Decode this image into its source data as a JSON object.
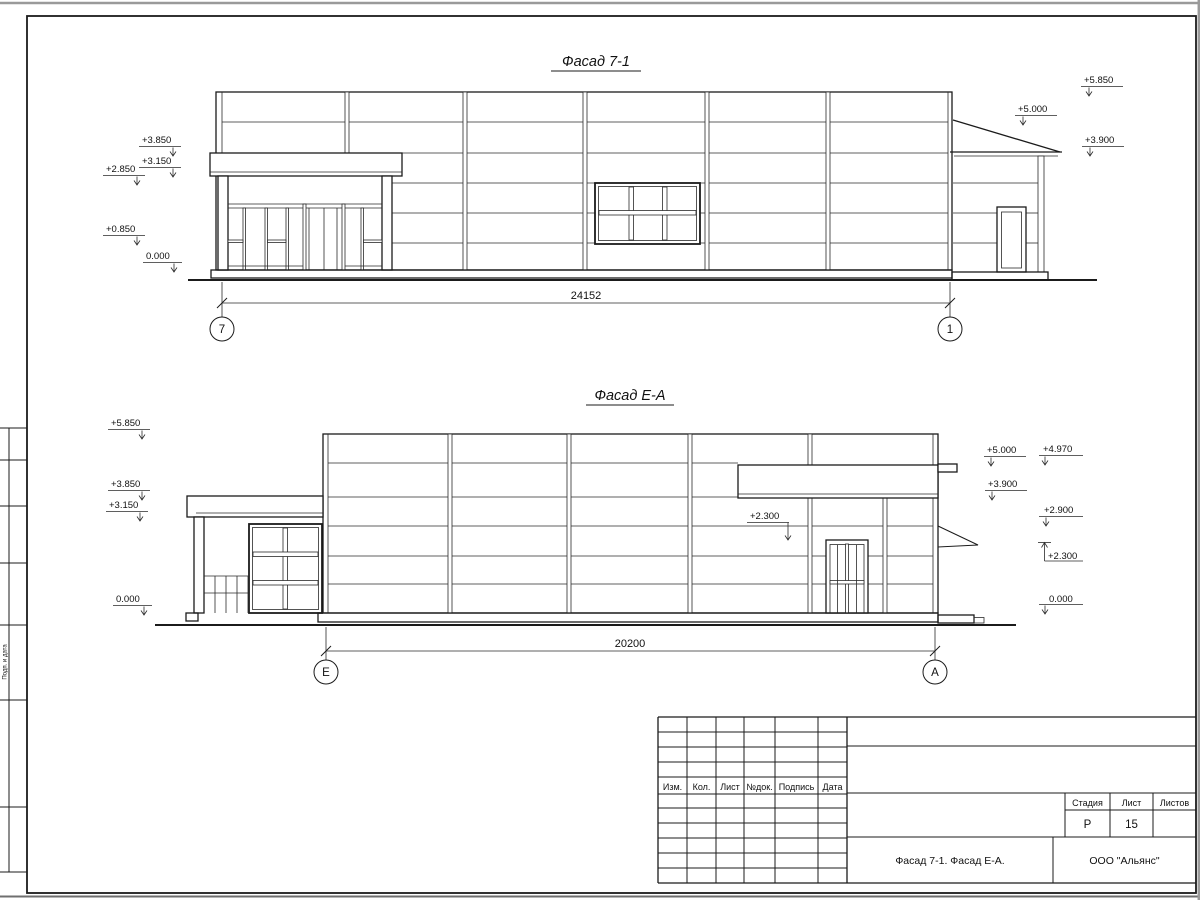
{
  "sheet": {
    "left_stamp_label": "Подп. и дата"
  },
  "facade_top": {
    "title": "Фасад 7-1",
    "dimension": "24152",
    "axis_left": "7",
    "axis_right": "1",
    "marks_left": [
      "+3.850",
      "+3.150",
      "+2.850",
      "+0.850",
      "0.000"
    ],
    "marks_right": [
      "+5.850",
      "+5.000",
      "+3.900"
    ]
  },
  "facade_bottom": {
    "title": "Фасад Е-А",
    "dimension": "20200",
    "axis_left": "Е",
    "axis_right": "А",
    "marks_left": [
      "+5.850",
      "+3.850",
      "+3.150",
      "0.000"
    ],
    "mark_middle": "+2.300",
    "marks_right": [
      "+5.000",
      "+4.970",
      "+3.900",
      "+2.900",
      "+2.300",
      "0.000"
    ]
  },
  "title_block": {
    "revision_columns": [
      "Изм.",
      "Кол.",
      "Лист",
      "№док.",
      "Подпись",
      "Дата"
    ],
    "stage_label": "Стадия",
    "sheet_label": "Лист",
    "sheets_label": "Листов",
    "stage_value": "Р",
    "sheet_value": "15",
    "sheets_value": "",
    "drawing_title": "Фасад 7-1. Фасад Е-А.",
    "organization": "ООО \"Альянс\""
  }
}
